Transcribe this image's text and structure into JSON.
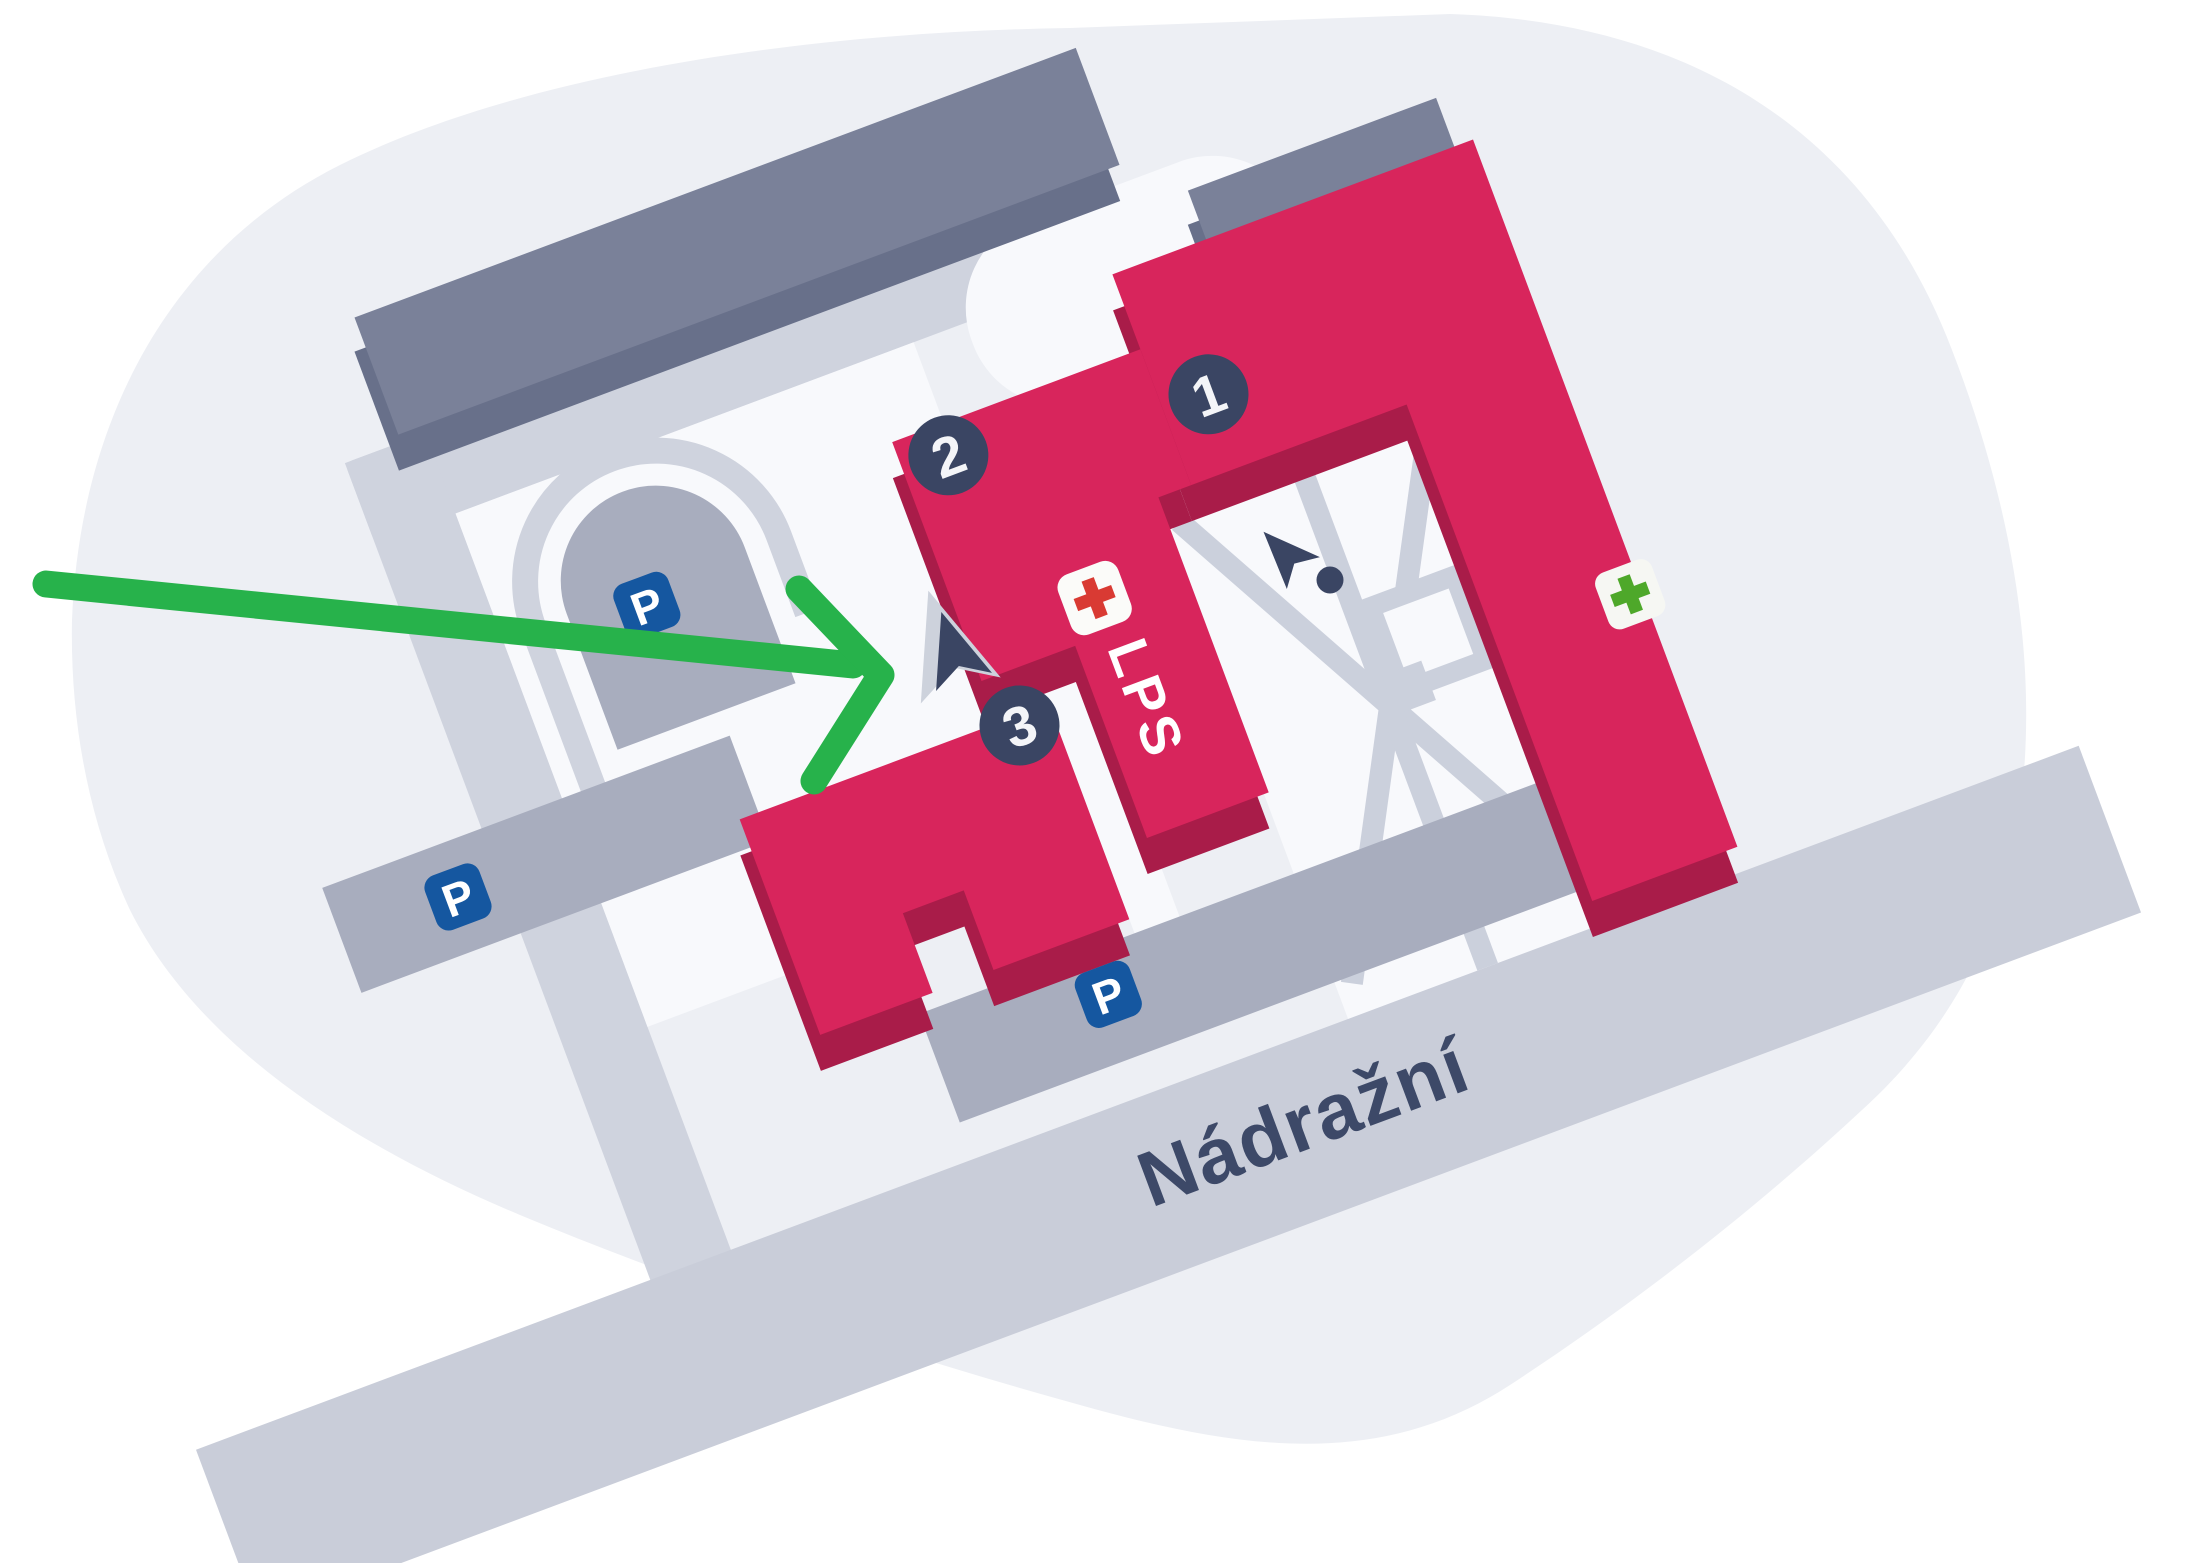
{
  "map": {
    "street_name": "Nádražní",
    "markers": [
      {
        "label": "1"
      },
      {
        "label": "2"
      },
      {
        "label": "3"
      }
    ],
    "lps_label": "LPS",
    "parking_label": "P",
    "parking_sign_count": 3,
    "icons": {
      "first_aid": "red-cross-icon",
      "pharmacy": "green-cross-icon",
      "entrance_pointer": "cursor-arrow-icon",
      "entrance_dot": "dot-icon",
      "route": "green-route-arrow"
    },
    "colors": {
      "background_blob": "#edeff4",
      "courtyard": "#f8f9fc",
      "road": "#cfd3de",
      "street": "#c9cdd9",
      "parking_area": "#a8adbe",
      "neutral_building_top": "#7a8199",
      "neutral_building_side": "#68708a",
      "highlight_building_top": "#d8255c",
      "highlight_building_side": "#a91c49",
      "marker": "#3a4563",
      "parking_sign": "#1557a0",
      "first_aid_red": "#d93a33",
      "pharmacy_green": "#4ea82a",
      "route_green": "#27b24b",
      "street_text": "#3d4968"
    }
  }
}
